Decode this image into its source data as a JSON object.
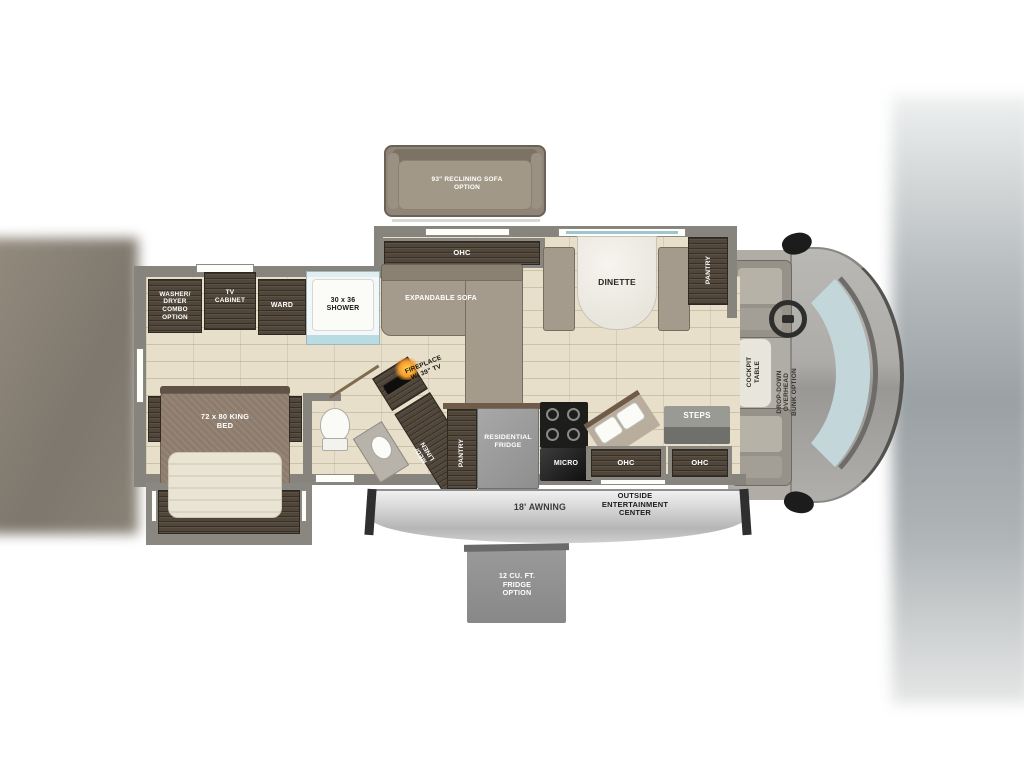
{
  "floorplan": {
    "labels": {
      "sofa_option": "93\" RECLINING SOFA OPTION",
      "ohc": "OHC",
      "expandable_sofa": "EXPANDABLE SOFA",
      "dinette": "DINETTE",
      "pantry": "PANTRY",
      "washer_dryer_option": "WASHER/ DRYER COMBO OPTION",
      "tv_cabinet": "TV CABINET",
      "ward": "WARD",
      "shower": "30 x 36 SHOWER",
      "king_bed": "72 x 80 KING BED",
      "fireplace": "FIREPLACE W/ 39\" TV",
      "med_linen": "MED/ LINEN",
      "residential_fridge": "RESIDENTIAL FRIDGE",
      "micro": "MICRO",
      "steps": "STEPS",
      "cockpit_table": "COCKPIT TABLE",
      "overhead_bunk_option": "DROP-DOWN OVERHEAD BUNK OPTION",
      "awning": "18' AWNING",
      "outside_entertainment": "OUTSIDE ENTERTAINMENT CENTER",
      "fridge_option": "12 CU. FT. FRIDGE OPTION"
    },
    "colors": {
      "floor": "#e7dfc9",
      "cabinet_wood": "#51463a",
      "wall": "#87837d",
      "sofa": "#a59b8c",
      "windshield": "#c3d7db",
      "appliance_gray": "#9c9c9c",
      "awning_gray": "#c9c9c9",
      "flame_accent": "#f59b2d"
    }
  }
}
